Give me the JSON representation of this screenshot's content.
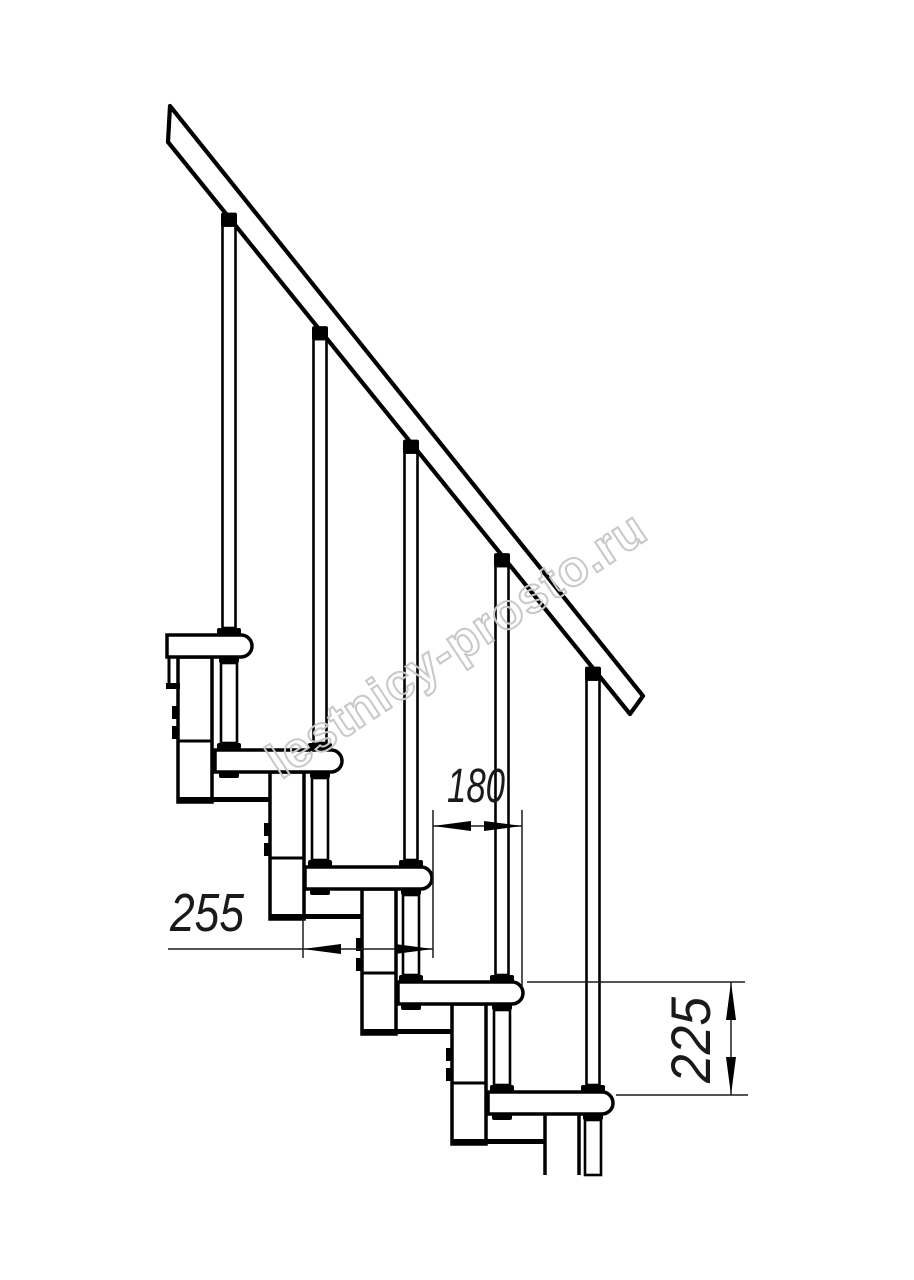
{
  "drawing": {
    "title": "modular-staircase-side-view",
    "dimensions": {
      "tread_depth": "255",
      "step_run": "180",
      "step_rise": "225"
    },
    "watermark": "lestnicy-prosto.ru",
    "colors": {
      "background": "#ffffff",
      "line": "#000000",
      "dimension_line": "#1c1c1c",
      "watermark_outline": "#c8c8c8"
    }
  }
}
